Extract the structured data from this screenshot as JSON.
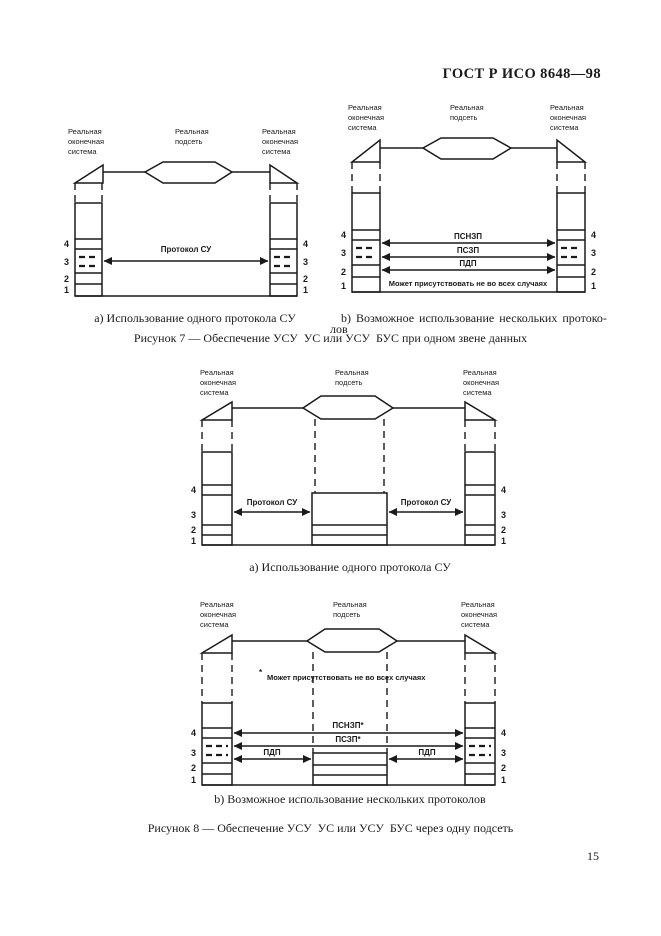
{
  "page": {
    "header": "ГОСТ Р ИСО 8648—98",
    "page_number": "15",
    "ink_color": "#1a1a1a",
    "background_color": "#ffffff"
  },
  "shared": {
    "end_system_label": [
      "Реальная",
      "оконечная",
      "система"
    ],
    "subnet_label": [
      "Реальная",
      "подсеть"
    ],
    "layer_numbers": [
      "4",
      "3",
      "2",
      "1"
    ]
  },
  "figure7": {
    "a": {
      "protocol_label": "Протокол СУ",
      "caption": "a) Использование одного протокола СУ"
    },
    "b": {
      "arrow_labels": [
        "ПСНЗП",
        "ПСЗП",
        "ПДП"
      ],
      "note": "Может присутствовать не во всех случаях",
      "caption_line1": "b) Возможное использование нескольких протоко-",
      "caption_line2": "лов"
    },
    "caption": "Рисунок 7 — Обеспечение УСУ  УС или УСУ  БУС при одном звене данных"
  },
  "figure8": {
    "a": {
      "protocol_label_left": "Протокол СУ",
      "protocol_label_right": "Протокол СУ",
      "caption": "a) Использование одного протокола СУ"
    },
    "b": {
      "note_star": "*",
      "note": "Может присутствовать не во всех случаях",
      "arrow_psnzp": "ПСНЗП*",
      "arrow_pszp": "ПСЗП*",
      "arrow_pdp_left": "ПДП",
      "arrow_pdp_right": "ПДП",
      "caption": "b) Возможное использование нескольких протоколов"
    },
    "caption": "Рисунок 8 — Обеспечение УСУ  УС или УСУ  БУС через одну подсеть"
  }
}
